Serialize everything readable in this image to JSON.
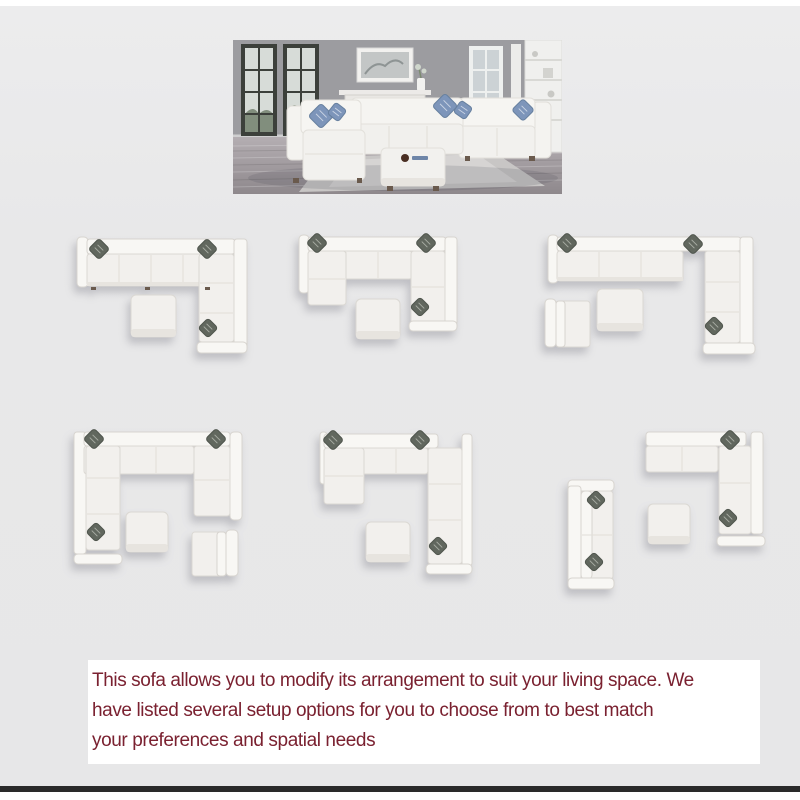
{
  "page": {
    "background_color": "#e9e9ea",
    "margin_color": "#ffffff",
    "bottom_bar_color": "#2a2a2a"
  },
  "hero_photo": {
    "name": "living-room-scene",
    "alt": "White modular sectional sofa with blue accent pillows and a square ottoman in a gray living room with dark-framed windows, marble fireplace, framed art and white shelving",
    "colors": {
      "wall": "#9c9ca0",
      "floor": "#a29ca0",
      "sofa": "#f3f2ef",
      "accent_pillow": "#7d95ba"
    }
  },
  "arrangement_figures": [
    {
      "name": "arrangement-l-shape-with-ottoman"
    },
    {
      "name": "arrangement-u-shape-chaise-with-ottoman"
    },
    {
      "name": "arrangement-l-shape-with-armless-chair-and-ottoman"
    },
    {
      "name": "arrangement-u-shape-chaise-with-ottoman-and-armless-chair"
    },
    {
      "name": "arrangement-l-shape-chaise-with-ottoman"
    },
    {
      "name": "arrangement-corner-sofa-with-ottoman-and-loveseat"
    }
  ],
  "caption": {
    "lines": [
      "This sofa allows you to modify its arrangement to suit your living space. We",
      "have listed several setup options for you to choose from to best match",
      "your preferences and spatial needs"
    ],
    "text_color": "#7a2130",
    "background_color": "#ffffff"
  }
}
